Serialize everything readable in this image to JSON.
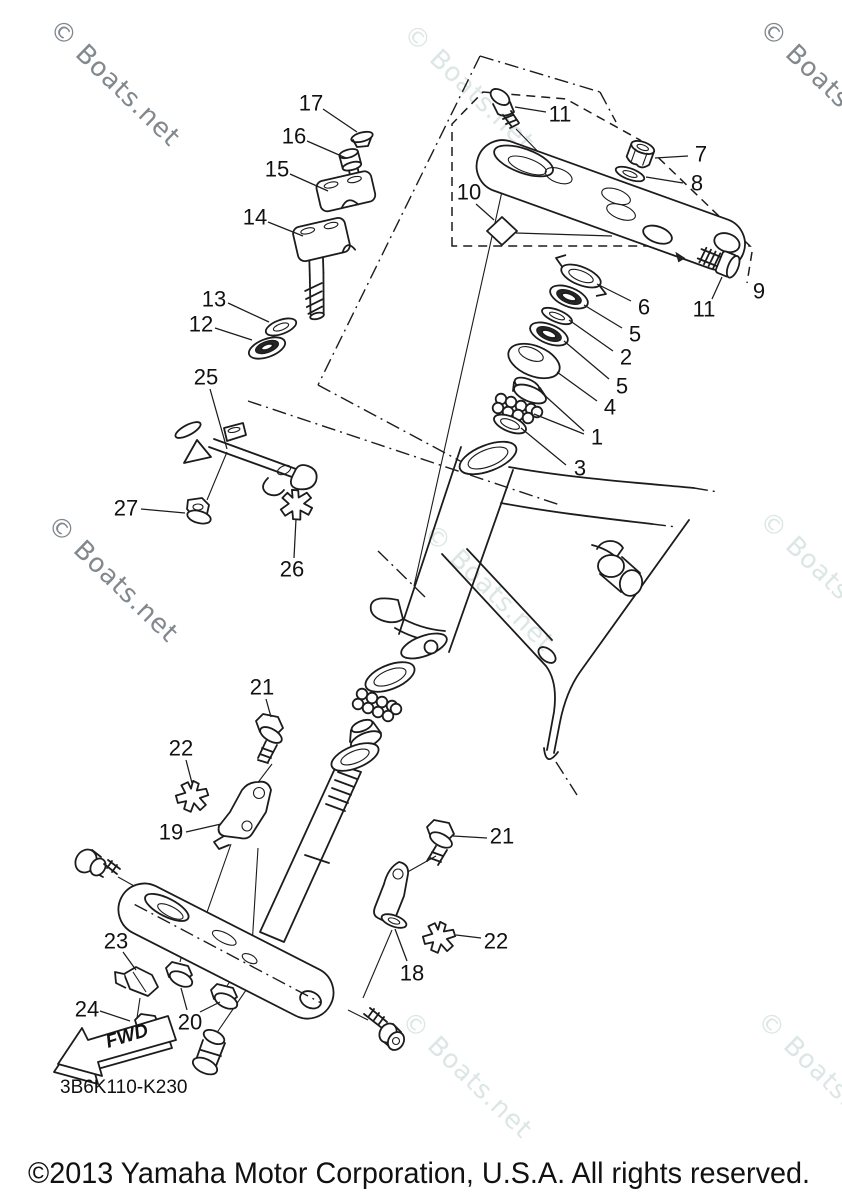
{
  "page": {
    "copyright": "©2013 Yamaha Motor Corporation, U.S.A. All rights reserved.",
    "diagram_code": "3B6K110-K230",
    "fwd_label": "FWD",
    "diagram_subject": "Steering exploded parts diagram"
  },
  "watermark": {
    "text": "© Boats.net",
    "angle": 44,
    "colors": {
      "dark": "#81888e",
      "light": "#dce7e5"
    },
    "positions": [
      {
        "x": 48,
        "y": 30,
        "shade": "dark"
      },
      {
        "x": 402,
        "y": 35,
        "shade": "light"
      },
      {
        "x": 758,
        "y": 30,
        "shade": "dark"
      },
      {
        "x": 46,
        "y": 526,
        "shade": "dark"
      },
      {
        "x": 422,
        "y": 535,
        "shade": "light"
      },
      {
        "x": 758,
        "y": 522,
        "shade": "light"
      },
      {
        "x": 400,
        "y": 1022,
        "shade": "light"
      },
      {
        "x": 756,
        "y": 1022,
        "shade": "light"
      }
    ]
  },
  "part_labels": [
    {
      "n": "17",
      "x": 311,
      "y": 103,
      "leaders": [
        [
          323,
          109,
          357,
          132
        ]
      ]
    },
    {
      "n": "16",
      "x": 294,
      "y": 136,
      "leaders": [
        [
          307,
          141,
          346,
          158
        ]
      ]
    },
    {
      "n": "15",
      "x": 277,
      "y": 169,
      "leaders": [
        [
          290,
          174,
          328,
          191
        ]
      ]
    },
    {
      "n": "14",
      "x": 255,
      "y": 217,
      "leaders": [
        [
          268,
          222,
          303,
          236
        ]
      ]
    },
    {
      "n": "13",
      "x": 214,
      "y": 299,
      "leaders": [
        [
          228,
          303,
          269,
          322
        ]
      ]
    },
    {
      "n": "12",
      "x": 201,
      "y": 324,
      "leaders": [
        [
          215,
          328,
          252,
          340
        ]
      ]
    },
    {
      "n": "25",
      "x": 206,
      "y": 377,
      "leaders": [
        [
          210,
          389,
          227,
          449
        ]
      ]
    },
    {
      "n": "27",
      "x": 126,
      "y": 508,
      "leaders": [
        [
          141,
          509,
          185,
          513
        ]
      ]
    },
    {
      "n": "26",
      "x": 292,
      "y": 569,
      "leaders": [
        [
          294,
          558,
          296,
          519
        ]
      ]
    },
    {
      "n": "11",
      "x": 560,
      "y": 114,
      "leaders": [
        [
          546,
          112,
          515,
          107
        ]
      ]
    },
    {
      "n": "7",
      "x": 701,
      "y": 154,
      "leaders": [
        [
          688,
          156,
          655,
          158
        ]
      ]
    },
    {
      "n": "8",
      "x": 697,
      "y": 183,
      "leaders": [
        [
          683,
          183,
          646,
          177
        ]
      ]
    },
    {
      "n": "10",
      "x": 469,
      "y": 192,
      "leaders": [
        [
          476,
          204,
          494,
          220
        ]
      ]
    },
    {
      "n": "9",
      "x": 759,
      "y": 291,
      "leaders": []
    },
    {
      "n": "11",
      "x": 704,
      "y": 309,
      "leaders": [
        [
          712,
          299,
          722,
          277
        ]
      ]
    },
    {
      "n": "6",
      "x": 644,
      "y": 307,
      "leaders": [
        [
          631,
          301,
          597,
          284
        ]
      ]
    },
    {
      "n": "5",
      "x": 635,
      "y": 334,
      "leaders": [
        [
          622,
          328,
          584,
          305
        ]
      ]
    },
    {
      "n": "2",
      "x": 626,
      "y": 357,
      "leaders": [
        [
          613,
          351,
          569,
          320
        ]
      ]
    },
    {
      "n": "5",
      "x": 622,
      "y": 386,
      "leaders": [
        [
          609,
          379,
          564,
          341
        ]
      ]
    },
    {
      "n": "4",
      "x": 610,
      "y": 407,
      "leaders": [
        [
          597,
          401,
          557,
          372
        ]
      ]
    },
    {
      "n": "1",
      "x": 597,
      "y": 437,
      "leaders": [
        [
          584,
          431,
          542,
          393
        ],
        [
          584,
          434,
          534,
          414
        ]
      ]
    },
    {
      "n": "3",
      "x": 580,
      "y": 468,
      "leaders": [
        [
          566,
          465,
          521,
          428
        ]
      ]
    },
    {
      "n": "21",
      "x": 262,
      "y": 687,
      "leaders": [
        [
          266,
          699,
          271,
          717
        ]
      ]
    },
    {
      "n": "22",
      "x": 181,
      "y": 748,
      "leaders": [
        [
          186,
          760,
          192,
          783
        ]
      ]
    },
    {
      "n": "19",
      "x": 171,
      "y": 832,
      "leaders": [
        [
          186,
          832,
          221,
          824
        ]
      ]
    },
    {
      "n": "21",
      "x": 502,
      "y": 836,
      "leaders": [
        [
          487,
          838,
          453,
          836
        ]
      ]
    },
    {
      "n": "18",
      "x": 412,
      "y": 973,
      "leaders": [
        [
          407,
          961,
          395,
          929
        ]
      ]
    },
    {
      "n": "22",
      "x": 496,
      "y": 941,
      "leaders": [
        [
          481,
          938,
          456,
          935
        ]
      ]
    },
    {
      "n": "23",
      "x": 116,
      "y": 941,
      "leaders": [
        [
          123,
          952,
          136,
          970
        ]
      ]
    },
    {
      "n": "24",
      "x": 87,
      "y": 1009,
      "leaders": [
        [
          100,
          1011,
          130,
          1021
        ]
      ]
    },
    {
      "n": "20",
      "x": 190,
      "y": 1022,
      "leaders": [
        [
          187,
          1010,
          181,
          988
        ],
        [
          200,
          1012,
          220,
          1002
        ]
      ]
    }
  ]
}
